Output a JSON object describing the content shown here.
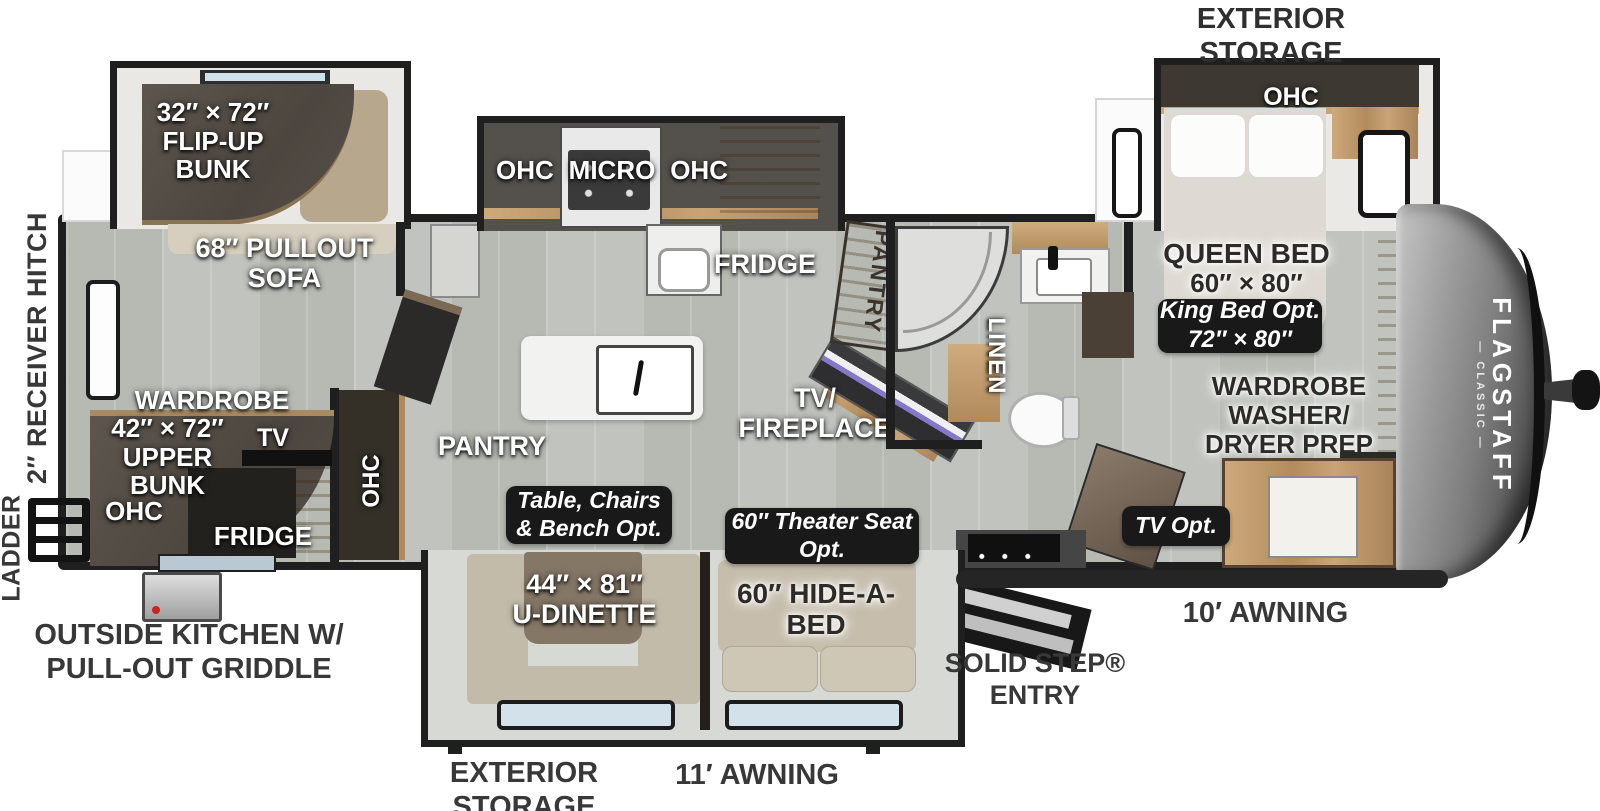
{
  "brand": {
    "name": "FLAGSTAFF",
    "series": "— CLASSIC —"
  },
  "exterior": {
    "storage_top_1": "EXTERIOR",
    "storage_top_2": "STORAGE",
    "storage_bottom_1": "EXTERIOR",
    "storage_bottom_2": "STORAGE",
    "awning_front": "10′ AWNING",
    "awning_main": "11′ AWNING",
    "solid_step_1": "SOLID STEP®",
    "solid_step_2": "ENTRY",
    "outside_kitchen_1": "OUTSIDE KITCHEN W/",
    "outside_kitchen_2": "PULL-OUT GRIDDLE",
    "receiver_hitch": "2″ RECEIVER HITCH",
    "ladder": "LADDER"
  },
  "bunk_room": {
    "flip_bunk_1": "32″ × 72″",
    "flip_bunk_2": "FLIP-UP",
    "flip_bunk_3": "BUNK",
    "pullout_sofa_1": "68″ PULLOUT",
    "pullout_sofa_2": "SOFA",
    "wardrobe": "WARDROBE",
    "wardrobe_size": "42″ × 72″",
    "upper": "UPPER",
    "bunk": "BUNK",
    "ohc": "OHC",
    "tv": "TV",
    "fridge": "FRIDGE"
  },
  "kitchen": {
    "ohc_left": "OHC",
    "micro": "MICRO",
    "ohc_right": "OHC",
    "fridge": "FRIDGE",
    "pantry": "PANTRY",
    "ohc_vert": "OHC",
    "pantry_cabinet": "PANTRY"
  },
  "living": {
    "tv_fireplace_1": "TV/",
    "tv_fireplace_2": "FIREPLACE"
  },
  "bathroom": {
    "linen": "LINEN"
  },
  "bedroom": {
    "ohc": "OHC",
    "queen_1": "QUEEN BED",
    "queen_2": "60″ × 80″",
    "king_1": "King Bed Opt.",
    "king_2": "72″ × 80″",
    "prep_1": "WARDROBE",
    "prep_2": "WASHER/",
    "prep_3": "DRYER PREP",
    "front_storage": "FRONT STORAGE",
    "tv_opt": "TV Opt."
  },
  "dinette": {
    "table_opt_1": "Table, Chairs",
    "table_opt_2": "& Bench  Opt.",
    "udinette_1": "44″ × 81″",
    "udinette_2": "U-DINETTE",
    "theater_1": "60″ Theater Seat",
    "theater_2": "Opt.",
    "hidebed_1": "60″ HIDE-A-",
    "hidebed_2": "BED"
  },
  "colors": {
    "wall": "#1f1f1f",
    "floor": "#bcbfb9",
    "wood": "#c09a6c",
    "cushion": "#c3bbaa",
    "badge": "#191919",
    "accent_purple": "#8577c9"
  }
}
